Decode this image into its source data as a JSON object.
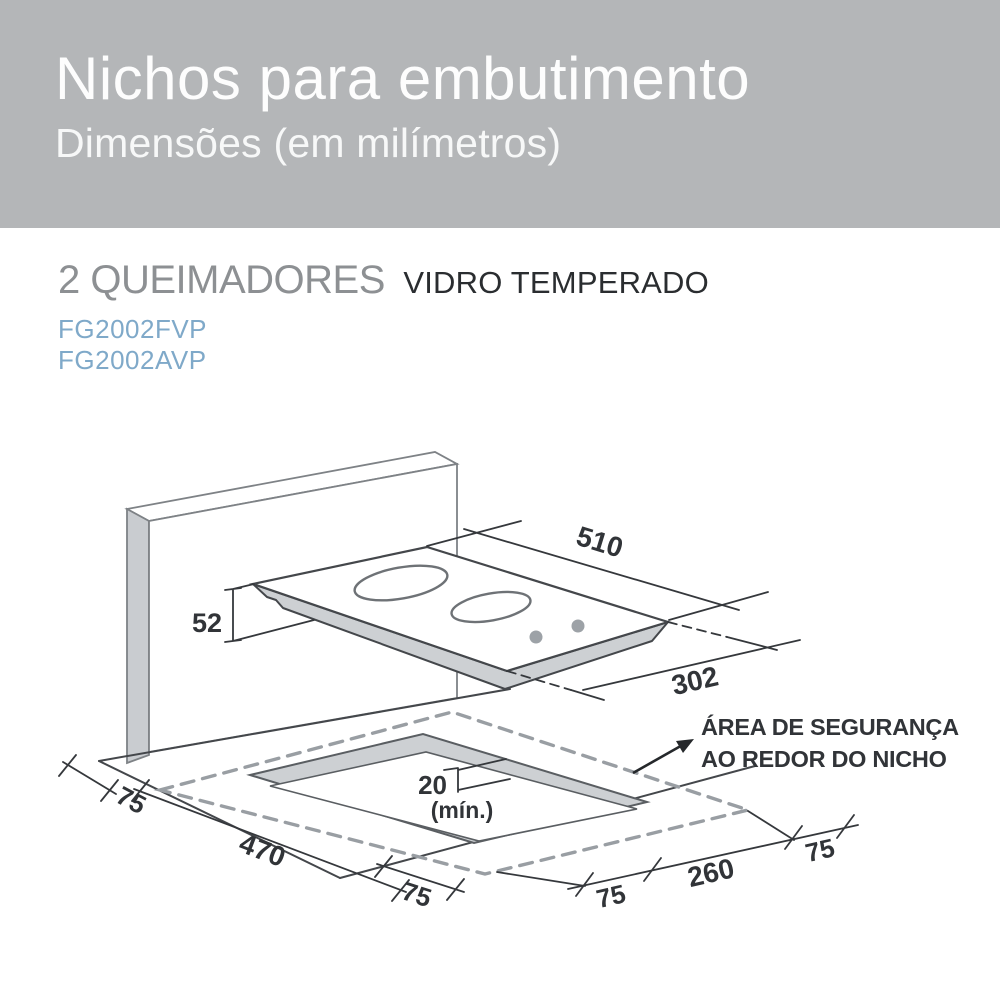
{
  "header": {
    "title": "Nichos para embutimento",
    "subtitle": "Dimensões (em milímetros)"
  },
  "product": {
    "burners_label": "2 QUEIMADORES",
    "type_label": "VIDRO TEMPERADO",
    "models": [
      "FG2002FVP",
      "FG2002AVP"
    ]
  },
  "diagram": {
    "labels": {
      "cooktop_width": "510",
      "cooktop_depth": "302",
      "cooktop_height": "52",
      "min_gap": "20",
      "min_gap_note": "(mín.)",
      "margin_left": "75",
      "niche_depth": "470",
      "margin_bottom": "75",
      "margin_right_near": "75",
      "niche_width": "260",
      "margin_right_far": "75"
    },
    "safety_note": {
      "line1": "ÁREA DE SEGURANÇA",
      "line2": "AO REDOR DO NICHO"
    }
  },
  "colors": {
    "header_bg": "#b4b6b8",
    "header_text": "#fdfdfd",
    "burners_label": "#8d9093",
    "type_label": "#2a2d30",
    "model_text": "#7fa9c9",
    "diagram_line": "#44474b",
    "diagram_fill_gray": "#cdd0d3",
    "safety_dash": "#999ea3"
  }
}
